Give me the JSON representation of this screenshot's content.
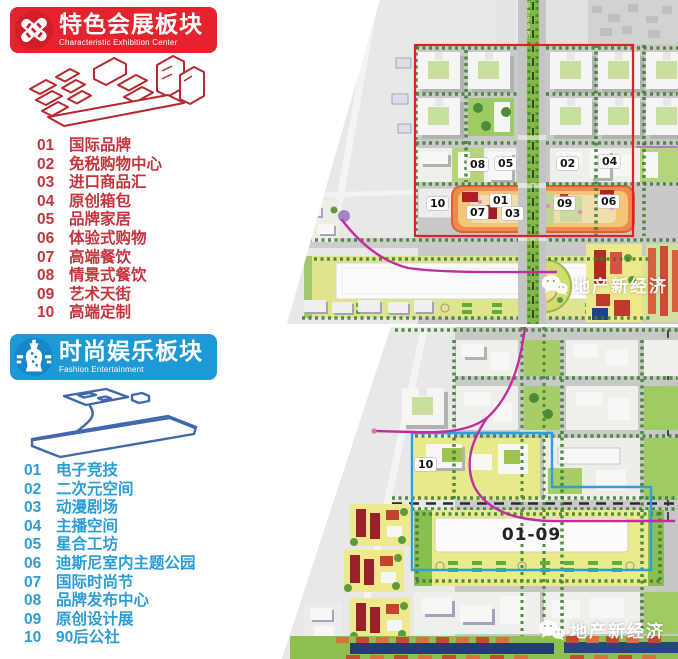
{
  "page": {
    "background": "#ffffff"
  },
  "sections": {
    "exhibition": {
      "icon": "crossed-buildings-icon",
      "title": "特色会展板块",
      "subtitle": "Characteristic Exhibition Center",
      "accent_color": "#e5232e",
      "text_color": "#c5343c",
      "items": [
        {
          "num": "01",
          "label": "国际品牌"
        },
        {
          "num": "02",
          "label": "免税购物中心"
        },
        {
          "num": "03",
          "label": "进口商品汇"
        },
        {
          "num": "04",
          "label": "原创箱包"
        },
        {
          "num": "05",
          "label": "品牌家居"
        },
        {
          "num": "06",
          "label": "体验式购物"
        },
        {
          "num": "07",
          "label": "高端餐饮"
        },
        {
          "num": "08",
          "label": "情景式餐饮"
        },
        {
          "num": "09",
          "label": "艺术天街"
        },
        {
          "num": "10",
          "label": "高端定制"
        }
      ]
    },
    "fashion": {
      "icon": "dress-form-icon",
      "title": "时尚娱乐板块",
      "subtitle": "Fashion Entertainment",
      "accent_color": "#1d9ad5",
      "text_color": "#2b9cd8",
      "items": [
        {
          "num": "01",
          "label": "电子竞技"
        },
        {
          "num": "02",
          "label": "二次元空间"
        },
        {
          "num": "03",
          "label": "动漫剧场"
        },
        {
          "num": "04",
          "label": "主播空间"
        },
        {
          "num": "05",
          "label": "星合工坊"
        },
        {
          "num": "06",
          "label": "迪斯尼室内主题公园"
        },
        {
          "num": "07",
          "label": "国际时尚节"
        },
        {
          "num": "08",
          "label": "品牌发布中心"
        },
        {
          "num": "09",
          "label": "原创设计展"
        },
        {
          "num": "10",
          "label": "90后公社"
        }
      ]
    }
  },
  "map_top": {
    "outline_color": "#e31e26",
    "road_label": "NG YIHUAN RD",
    "markers": [
      {
        "label": "08"
      },
      {
        "label": "05"
      },
      {
        "label": "02"
      },
      {
        "label": "04"
      },
      {
        "label": "10"
      },
      {
        "label": "07"
      },
      {
        "label": "01"
      },
      {
        "label": "03"
      },
      {
        "label": "09"
      },
      {
        "label": "06"
      }
    ]
  },
  "map_bottom": {
    "outline_color": "#2ba0da",
    "marker": {
      "label": "10"
    },
    "building_label": "01-09"
  },
  "watermark": {
    "icon": "wechat-icon",
    "text": "地产新经济"
  }
}
